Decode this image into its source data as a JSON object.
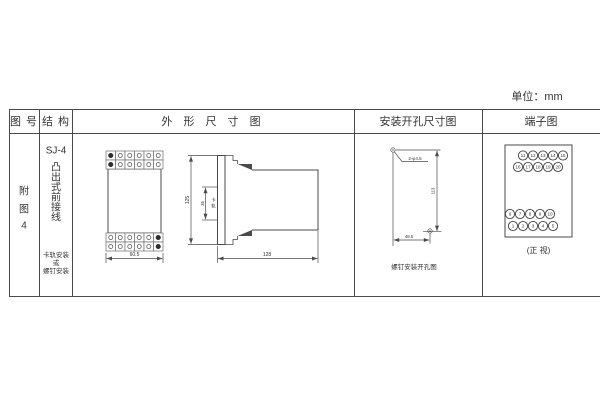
{
  "unit_label": "单位：mm",
  "colors": {
    "line": "#4a4a4a",
    "text": "#333333",
    "bg": "#ffffff"
  },
  "table": {
    "headers": {
      "figure_no": "图 号",
      "structure": "结 构",
      "outline": "外 形 尺 寸 图",
      "mounting": "安装开孔尺寸图",
      "terminal": "端子图"
    },
    "row": {
      "figure_no_chars": [
        "附",
        "图",
        "4"
      ],
      "structure": {
        "model": "SJ-4",
        "type_chars": [
          "凸",
          "出",
          "式",
          "前",
          "接",
          "线"
        ],
        "mount_note_lines": [
          "卡轨安装",
          "或",
          "螺钉安装"
        ]
      }
    }
  },
  "outline_view": {
    "front": {
      "width_dim": "60.5"
    },
    "side": {
      "height_dim": "125",
      "rail_slot_dim": "35",
      "rail_label_chars": [
        "卡",
        "轨"
      ],
      "depth_dim": "128"
    }
  },
  "mounting_view": {
    "holes_label": "2-φ4.5",
    "vertical_dim": "113",
    "horizontal_dim": "48.5",
    "caption": "螺钉安装开孔图"
  },
  "terminal_view": {
    "rows": [
      [
        "11",
        "12",
        "13",
        "14",
        "15"
      ],
      [
        "16",
        "17",
        "18",
        "19",
        "20"
      ],
      [
        "6",
        "7",
        "8",
        "9",
        "10"
      ],
      [
        "1",
        "2",
        "3",
        "4",
        "5"
      ]
    ],
    "caption": "(正 视)"
  }
}
